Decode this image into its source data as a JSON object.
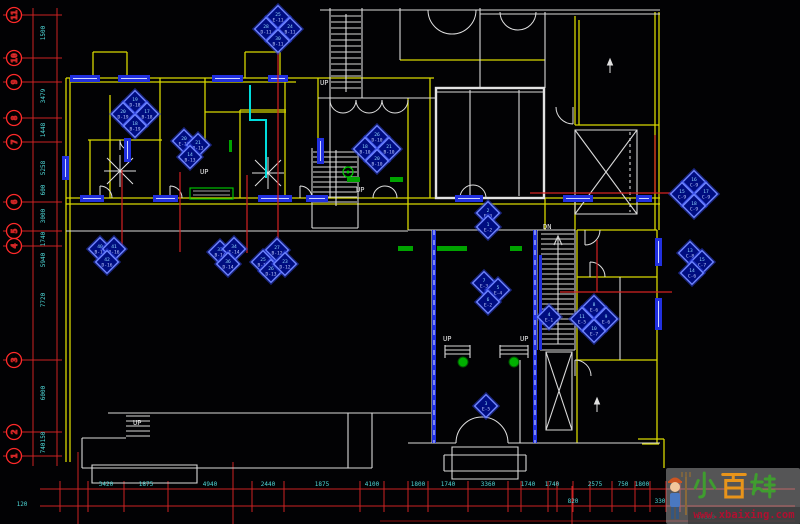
{
  "grid_bubbles": [
    {
      "n": "11",
      "y": 15
    },
    {
      "n": "10",
      "y": 58
    },
    {
      "n": "9",
      "y": 82
    },
    {
      "n": "8",
      "y": 118
    },
    {
      "n": "7",
      "y": 142
    },
    {
      "n": "6",
      "y": 202
    },
    {
      "n": "5",
      "y": 231
    },
    {
      "n": "4",
      "y": 246
    },
    {
      "n": "3",
      "y": 360
    },
    {
      "n": "2",
      "y": 432
    },
    {
      "n": "1",
      "y": 456
    }
  ],
  "left_dims": [
    {
      "t": "1500",
      "y": 33
    },
    {
      "t": "3479",
      "y": 96
    },
    {
      "t": "1448",
      "y": 130
    },
    {
      "t": "5258",
      "y": 168
    },
    {
      "t": "600",
      "y": 190
    },
    {
      "t": "3000",
      "y": 216
    },
    {
      "t": "1740",
      "y": 239
    },
    {
      "t": "5940",
      "y": 260
    },
    {
      "t": "7720",
      "y": 300
    },
    {
      "t": "6000",
      "y": 393
    },
    {
      "t": "150",
      "y": 437
    },
    {
      "t": "740",
      "y": 448
    }
  ],
  "bottom_dims_row1": [
    {
      "t": "3420",
      "x": 106
    },
    {
      "t": "1875",
      "x": 146
    },
    {
      "t": "4940",
      "x": 210
    },
    {
      "t": "2440",
      "x": 268
    },
    {
      "t": "1875",
      "x": 322
    },
    {
      "t": "4100",
      "x": 372
    },
    {
      "t": "1800",
      "x": 418
    },
    {
      "t": "1740",
      "x": 448
    },
    {
      "t": "3360",
      "x": 488
    },
    {
      "t": "1740",
      "x": 528
    },
    {
      "t": "1740",
      "x": 552
    },
    {
      "t": "2575",
      "x": 595
    },
    {
      "t": "750",
      "x": 623
    },
    {
      "t": "1800",
      "x": 642
    }
  ],
  "bottom_dims_row2": [
    {
      "t": "820",
      "x": 573
    },
    {
      "t": "330",
      "x": 660
    }
  ],
  "bottom_total": {
    "t": "57360",
    "x": 706,
    "y": 519
  },
  "corner_dim": {
    "t": "120",
    "x": 22,
    "y": 506
  },
  "stair_labels": [
    {
      "t": "UP",
      "x": 320,
      "y": 85
    },
    {
      "t": "UP",
      "x": 200,
      "y": 174
    },
    {
      "t": "UP",
      "x": 356,
      "y": 192
    },
    {
      "t": "DN",
      "x": 543,
      "y": 229
    },
    {
      "t": "UP",
      "x": 443,
      "y": 341
    },
    {
      "t": "UP",
      "x": 520,
      "y": 341
    },
    {
      "t": "UP",
      "x": 133,
      "y": 425
    }
  ],
  "clusters": [
    {
      "x": 278,
      "y": 28,
      "tags": [
        {
          "n": "25",
          "c": "E-11",
          "dx": 0,
          "dy": -11
        },
        {
          "n": "28",
          "c": "D-11",
          "dx": -12,
          "dy": 1
        },
        {
          "n": "24",
          "c": "B-11",
          "dx": 12,
          "dy": 1
        },
        {
          "n": "30",
          "c": "B-11",
          "dx": 0,
          "dy": 13
        }
      ]
    },
    {
      "x": 135,
      "y": 113,
      "tags": [
        {
          "n": "19",
          "c": "D-18",
          "dx": 0,
          "dy": -11
        },
        {
          "n": "20",
          "c": "D-19",
          "dx": -12,
          "dy": 1
        },
        {
          "n": "17",
          "c": "B-18",
          "dx": 12,
          "dy": 1
        },
        {
          "n": "18",
          "c": "B-19",
          "dx": 0,
          "dy": 13
        }
      ]
    },
    {
      "x": 190,
      "y": 150,
      "tags": [
        {
          "n": "20",
          "c": "E-13",
          "dx": -6,
          "dy": -9
        },
        {
          "n": "21",
          "c": "B-13",
          "dx": 8,
          "dy": -5
        },
        {
          "n": "14",
          "c": "B-13",
          "dx": 0,
          "dy": 7
        }
      ]
    },
    {
      "x": 377,
      "y": 148,
      "tags": [
        {
          "n": "26",
          "c": "D-10",
          "dx": 0,
          "dy": -11
        },
        {
          "n": "18",
          "c": "B-10",
          "dx": -12,
          "dy": 1
        },
        {
          "n": "21",
          "c": "B-10",
          "dx": 12,
          "dy": 1
        },
        {
          "n": "20",
          "c": "B-10",
          "dx": 0,
          "dy": 13
        }
      ]
    },
    {
      "x": 107,
      "y": 256,
      "tags": [
        {
          "n": "40",
          "c": "B-17",
          "dx": -7,
          "dy": -7
        },
        {
          "n": "41",
          "c": "B-16",
          "dx": 7,
          "dy": -7
        },
        {
          "n": "42",
          "c": "D-16",
          "dx": 0,
          "dy": 6
        }
      ]
    },
    {
      "x": 228,
      "y": 257,
      "tags": [
        {
          "n": "33",
          "c": "B-14",
          "dx": -8,
          "dy": -5
        },
        {
          "n": "34",
          "c": "E-14",
          "dx": 6,
          "dy": -8
        },
        {
          "n": "36",
          "c": "D-14",
          "dx": 0,
          "dy": 7
        }
      ]
    },
    {
      "x": 273,
      "y": 260,
      "tags": [
        {
          "n": "27",
          "c": "B-12",
          "dx": 4,
          "dy": -10
        },
        {
          "n": "25",
          "c": "B-13",
          "dx": -10,
          "dy": 2
        },
        {
          "n": "26",
          "c": "D-13",
          "dx": -2,
          "dy": 11
        },
        {
          "n": "23",
          "c": "D-12",
          "dx": 12,
          "dy": 4
        }
      ]
    },
    {
      "x": 488,
      "y": 220,
      "tags": [
        {
          "n": "2",
          "c": "E-3",
          "dx": 0,
          "dy": -7
        },
        {
          "n": "1",
          "c": "E-2",
          "dx": 0,
          "dy": 7
        }
      ]
    },
    {
      "x": 490,
      "y": 292,
      "tags": [
        {
          "n": "7",
          "c": "E-3",
          "dx": -6,
          "dy": -9
        },
        {
          "n": "5",
          "c": "E-4",
          "dx": 8,
          "dy": -2
        },
        {
          "n": "6",
          "c": "E-2",
          "dx": -2,
          "dy": 10
        }
      ]
    },
    {
      "x": 549,
      "y": 317,
      "tags": [
        {
          "n": "4",
          "c": "E-1",
          "dx": 0,
          "dy": 0
        }
      ]
    },
    {
      "x": 594,
      "y": 318,
      "tags": [
        {
          "n": "8",
          "c": "E-6",
          "dx": 0,
          "dy": -11
        },
        {
          "n": "11",
          "c": "E-5",
          "dx": -12,
          "dy": 1
        },
        {
          "n": "9",
          "c": "E-6",
          "dx": 12,
          "dy": 1
        },
        {
          "n": "10",
          "c": "E-7",
          "dx": 0,
          "dy": 13
        }
      ]
    },
    {
      "x": 486,
      "y": 406,
      "tags": [
        {
          "n": "3",
          "c": "E-5",
          "dx": 0,
          "dy": 0
        }
      ]
    },
    {
      "x": 694,
      "y": 193,
      "tags": [
        {
          "n": "16",
          "c": "C-9",
          "dx": 0,
          "dy": -11
        },
        {
          "n": "15",
          "c": "C-9",
          "dx": -12,
          "dy": 1
        },
        {
          "n": "17",
          "c": "C-9",
          "dx": 12,
          "dy": 1
        },
        {
          "n": "18",
          "c": "C-9",
          "dx": 0,
          "dy": 13
        }
      ]
    },
    {
      "x": 694,
      "y": 262,
      "tags": [
        {
          "n": "13",
          "c": "C-8",
          "dx": -4,
          "dy": -9
        },
        {
          "n": "15",
          "c": "C-7",
          "dx": 8,
          "dy": 0
        },
        {
          "n": "14",
          "c": "C-6",
          "dx": -2,
          "dy": 11
        }
      ]
    }
  ],
  "watermark": {
    "brand": "小百姓",
    "brand_chars": [
      {
        "ch": "小",
        "color": "#3f9d2f"
      },
      {
        "ch": "百",
        "color": "#e8941a"
      },
      {
        "ch": "姓",
        "color": "#3f9d2f"
      }
    ],
    "url": "www.xbaixing.com"
  },
  "colors": {
    "wall_yellow": "#d8d800",
    "detail_white": "#d9d9d9",
    "window_blue": "#2130e0",
    "tag_fill": "#000d80",
    "tag_edge": "#6e84ff",
    "grid_red": "#e03030",
    "dim_cyan": "#4fd9d9",
    "accent_green": "#00a300"
  }
}
